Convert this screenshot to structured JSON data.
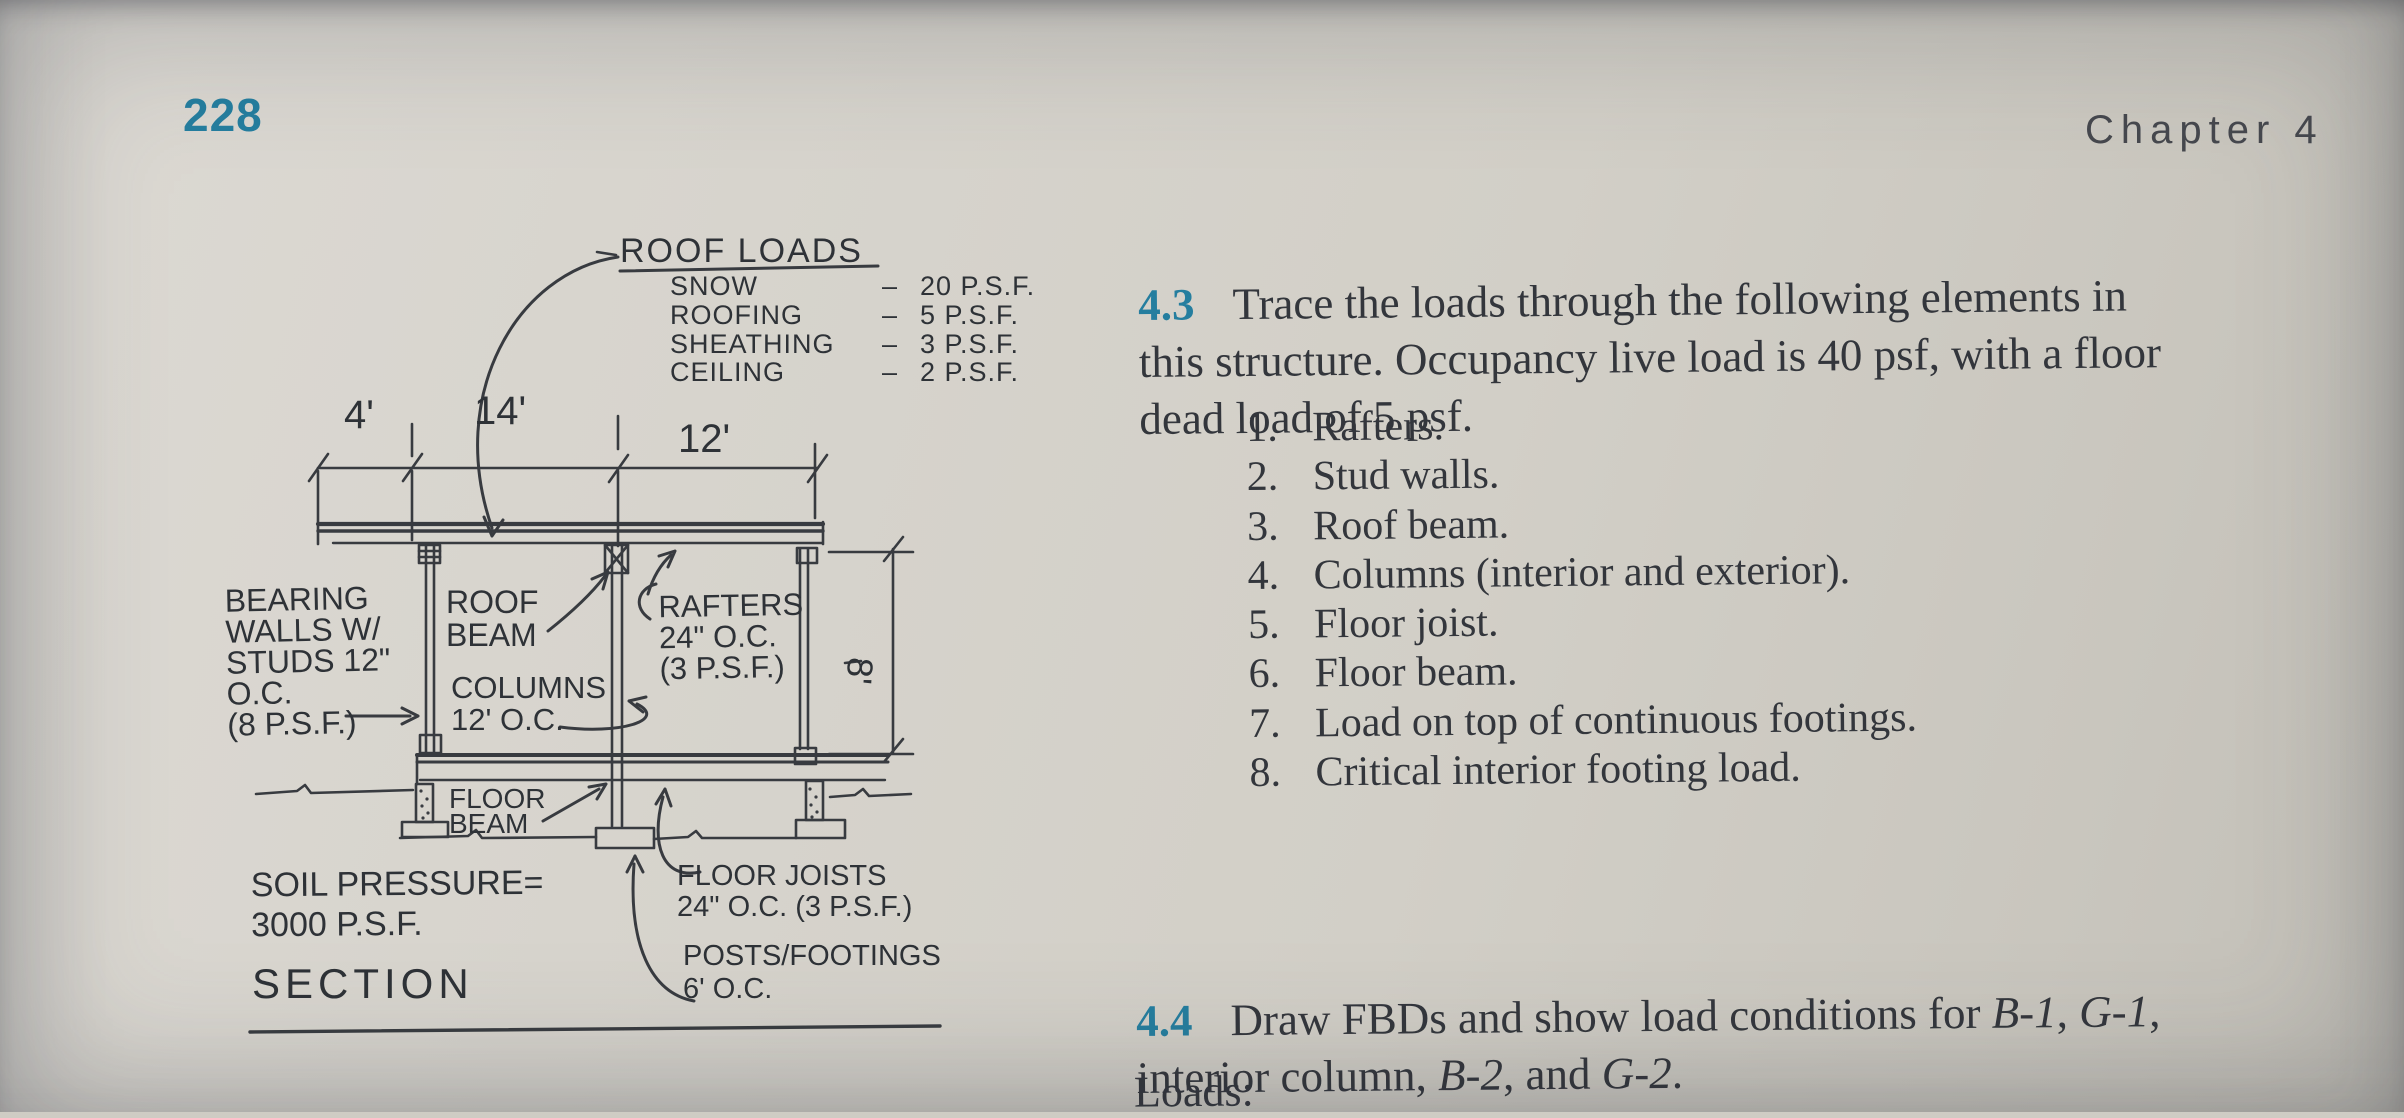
{
  "colors": {
    "accent": "#257e9f",
    "ink": "#2e3237",
    "paper": "#d5d2ca"
  },
  "page": {
    "number": "228",
    "chapter": "Chapter 4"
  },
  "diagram": {
    "roof_loads": {
      "title": "ROOF LOADS",
      "separator": "–",
      "items": [
        {
          "name": "SNOW",
          "value": "20 P.S.F."
        },
        {
          "name": "ROOFING",
          "value": "5 P.S.F."
        },
        {
          "name": "SHEATHING",
          "value": "3 P.S.F."
        },
        {
          "name": "CEILING",
          "value": "2 P.S.F."
        }
      ]
    },
    "dimensions": {
      "overhang": "4'",
      "span_left": "14'",
      "span_right": "12'",
      "height": "8'"
    },
    "labels": {
      "bearing_walls": "BEARING\nWALLS W/\nSTUDS 12\"\nO.C.\n(8 P.S.F.)",
      "roof_beam": "ROOF\nBEAM",
      "columns": "COLUMNS\n12' O.C.",
      "rafters": "RAFTERS\n24\" O.C.\n(3 P.S.F.)",
      "floor_beam": "FLOOR\nBEAM",
      "soil_pressure": "SOIL PRESSURE=\n3000 P.S.F.",
      "floor_joists": "FLOOR JOISTS\n24\" O.C. (3 P.S.F.)",
      "posts_footings": "POSTS/FOOTINGS\n6' O.C.",
      "section": "SECTION"
    }
  },
  "problems": {
    "p43": {
      "number": "4.3",
      "text": "Trace the loads through the following elements in\nthis structure. Occupancy live load is 40 psf, with a floor\ndead load of 5 psf.",
      "items": [
        {
          "num": "1.",
          "label": "Rafters."
        },
        {
          "num": "2.",
          "label": "Stud walls."
        },
        {
          "num": "3.",
          "label": "Roof beam."
        },
        {
          "num": "4.",
          "label": "Columns (interior and exterior)."
        },
        {
          "num": "5.",
          "label": "Floor joist."
        },
        {
          "num": "6.",
          "label": "Floor beam."
        },
        {
          "num": "7.",
          "label": "Load on top of continuous footings."
        },
        {
          "num": "8.",
          "label": "Critical interior footing load."
        }
      ]
    },
    "p44": {
      "number": "4.4",
      "segments": [
        {
          "text": "Draw FBDs and show load conditions for ",
          "italic": false
        },
        {
          "text": "B-1",
          "italic": true
        },
        {
          "text": ", ",
          "italic": false
        },
        {
          "text": "G-1",
          "italic": true
        },
        {
          "text": ",\ninterior column, ",
          "italic": false
        },
        {
          "text": "B-2",
          "italic": true
        },
        {
          "text": ", and ",
          "italic": false
        },
        {
          "text": "G-2",
          "italic": true
        },
        {
          "text": ".",
          "italic": false
        }
      ]
    },
    "loads_label": "Loads:"
  }
}
